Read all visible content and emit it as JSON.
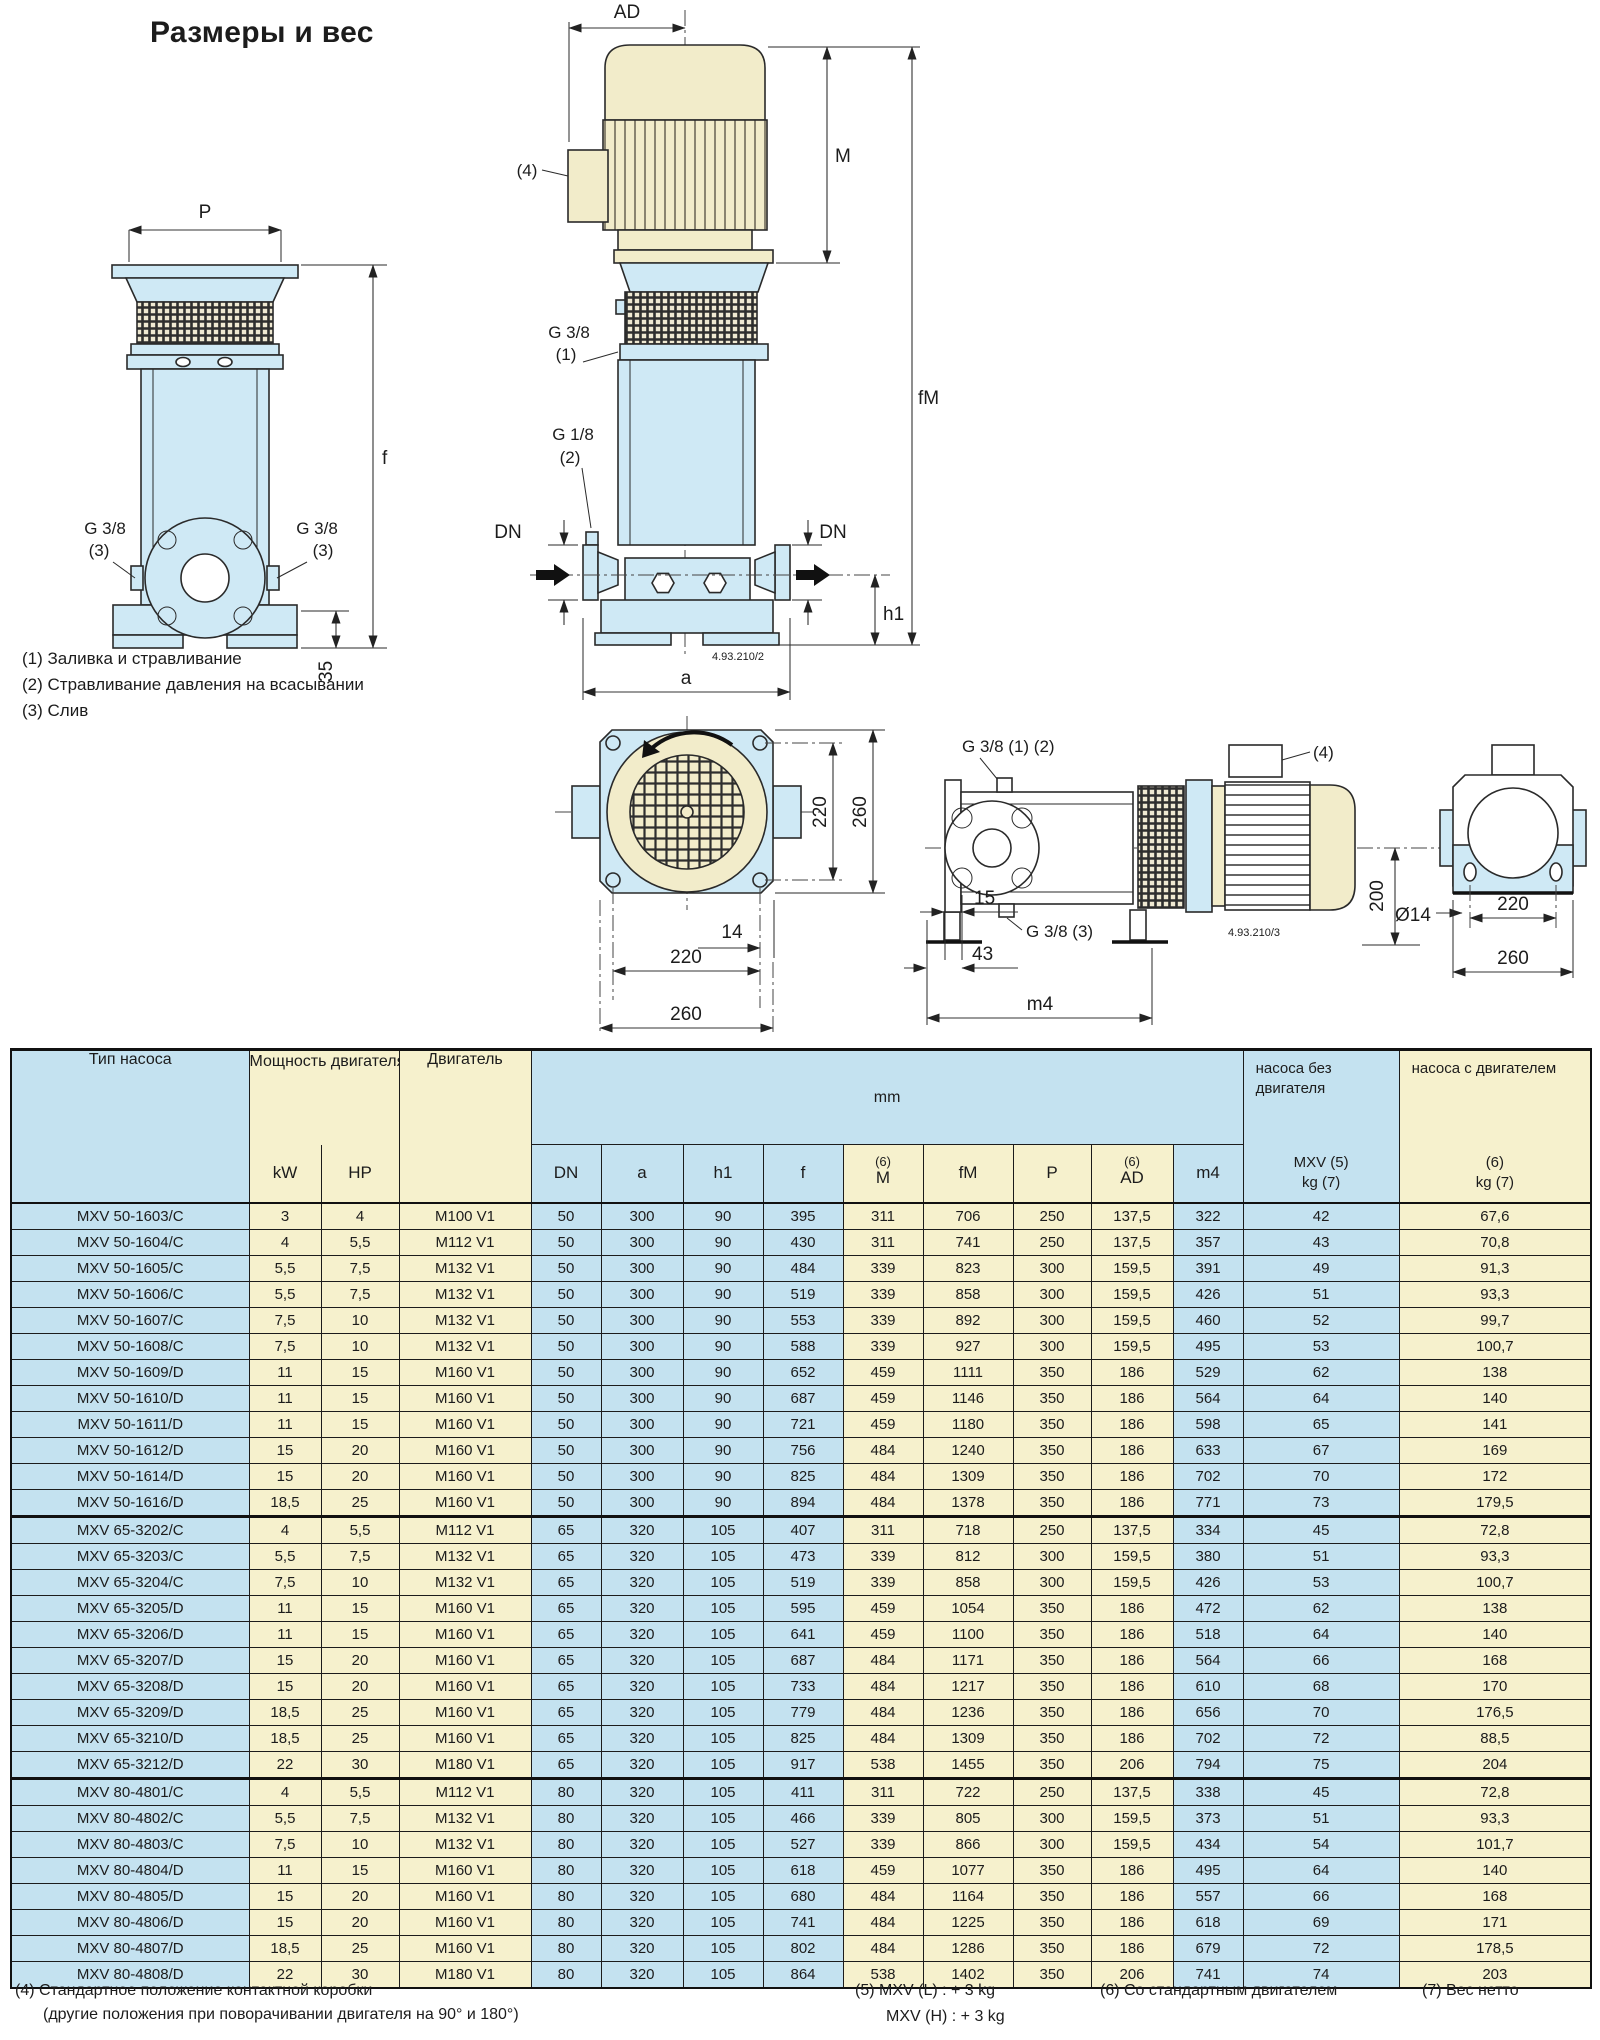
{
  "page": {
    "title": "Размеры и вес",
    "notes_left": {
      "n1": "(1) Заливка и стравливание",
      "n2": "(2) Стравливание давления на всасывании",
      "n3": "(3) Слив"
    },
    "footer_notes": {
      "n4_line1": "(4) Стандартное положение контактной коробки",
      "n4_line2": "(другие положения при поворачивании двигателя на 90° и 180°)",
      "n5_line1": "(5) MXV (L) : + 3 kg",
      "n5_line2": "MXV (H) : + 3 kg",
      "n6": "(6) Со стандартным двигателем",
      "n7": "(7) Вес нетто"
    },
    "colors": {
      "table_blue": "#c4e2f0",
      "table_yellow": "#f6f1cd",
      "drawing_blue": "#cfe9f5",
      "drawing_cream": "#f2ecca"
    }
  },
  "drawings": {
    "left": {
      "p": "P",
      "f": "f",
      "g38": "G 3/8",
      "n3": "(3)",
      "d35": "35"
    },
    "middle": {
      "ad": "AD",
      "n4": "(4)",
      "m": "M",
      "fm": "fM",
      "g38": "G 3/8",
      "n1": "(1)",
      "g18": "G 1/8",
      "n2": "(2)",
      "dn": "DN",
      "h1": "h1",
      "a": "a",
      "code": "4.93.210/2"
    },
    "bottom": {
      "v220": "220",
      "v260": "260",
      "d14": "14",
      "h220": "220",
      "h260": "260"
    },
    "right": {
      "g38_12": "G 3/8 (1) (2)",
      "g38_3": "G 3/8 (3)",
      "n4": "(4)",
      "code": "4.93.210/3",
      "d200": "200",
      "d14": "Ø14",
      "d15": "15",
      "d43": "43",
      "m4": "m4",
      "d220": "220",
      "d260": "260"
    }
  },
  "table": {
    "headers": {
      "type": "Тип насоса",
      "power": "Мощность двигателя",
      "kw": "kW",
      "hp": "HP",
      "motor": "Двигатель",
      "mm": "mm",
      "dn": "DN",
      "a": "a",
      "h1": "h1",
      "f": "f",
      "m6": "(6)",
      "m": "M",
      "fm": "fM",
      "p": "P",
      "ad6": "(6)",
      "ad": "AD",
      "m4": "m4",
      "w1_top": "насоса без двигателя",
      "w1_mid": "MXV (5)",
      "w1_bot": "kg (7)",
      "w2_top": "насоса с двигателем",
      "w2_mid": "(6)",
      "w2_bot": "kg (7)"
    },
    "columns": [
      "type",
      "kw",
      "hp",
      "motor",
      "dn",
      "a",
      "h1",
      "f",
      "m",
      "fm",
      "p",
      "ad",
      "m4",
      "kg1",
      "kg2"
    ],
    "col_colors": {
      "type": "b",
      "kw": "y",
      "hp": "y",
      "motor": "y",
      "dn": "b",
      "a": "b",
      "h1": "b",
      "f": "b",
      "m": "y",
      "fm": "y",
      "p": "y",
      "ad": "y",
      "m4": "b",
      "kg1": "b",
      "kg2": "y"
    },
    "groups": [
      [
        [
          "MXV 50-1603/C",
          "3",
          "4",
          "M100 V1",
          "50",
          "300",
          "90",
          "395",
          "311",
          "706",
          "250",
          "137,5",
          "322",
          "42",
          "67,6"
        ],
        [
          "MXV 50-1604/C",
          "4",
          "5,5",
          "M112 V1",
          "50",
          "300",
          "90",
          "430",
          "311",
          "741",
          "250",
          "137,5",
          "357",
          "43",
          "70,8"
        ],
        [
          "MXV 50-1605/C",
          "5,5",
          "7,5",
          "M132 V1",
          "50",
          "300",
          "90",
          "484",
          "339",
          "823",
          "300",
          "159,5",
          "391",
          "49",
          "91,3"
        ],
        [
          "MXV 50-1606/C",
          "5,5",
          "7,5",
          "M132 V1",
          "50",
          "300",
          "90",
          "519",
          "339",
          "858",
          "300",
          "159,5",
          "426",
          "51",
          "93,3"
        ],
        [
          "MXV 50-1607/C",
          "7,5",
          "10",
          "M132 V1",
          "50",
          "300",
          "90",
          "553",
          "339",
          "892",
          "300",
          "159,5",
          "460",
          "52",
          "99,7"
        ],
        [
          "MXV 50-1608/C",
          "7,5",
          "10",
          "M132 V1",
          "50",
          "300",
          "90",
          "588",
          "339",
          "927",
          "300",
          "159,5",
          "495",
          "53",
          "100,7"
        ],
        [
          "MXV 50-1609/D",
          "11",
          "15",
          "M160 V1",
          "50",
          "300",
          "90",
          "652",
          "459",
          "1111",
          "350",
          "186",
          "529",
          "62",
          "138"
        ],
        [
          "MXV 50-1610/D",
          "11",
          "15",
          "M160 V1",
          "50",
          "300",
          "90",
          "687",
          "459",
          "1146",
          "350",
          "186",
          "564",
          "64",
          "140"
        ],
        [
          "MXV 50-1611/D",
          "11",
          "15",
          "M160 V1",
          "50",
          "300",
          "90",
          "721",
          "459",
          "1180",
          "350",
          "186",
          "598",
          "65",
          "141"
        ],
        [
          "MXV 50-1612/D",
          "15",
          "20",
          "M160 V1",
          "50",
          "300",
          "90",
          "756",
          "484",
          "1240",
          "350",
          "186",
          "633",
          "67",
          "169"
        ],
        [
          "MXV 50-1614/D",
          "15",
          "20",
          "M160 V1",
          "50",
          "300",
          "90",
          "825",
          "484",
          "1309",
          "350",
          "186",
          "702",
          "70",
          "172"
        ],
        [
          "MXV 50-1616/D",
          "18,5",
          "25",
          "M160 V1",
          "50",
          "300",
          "90",
          "894",
          "484",
          "1378",
          "350",
          "186",
          "771",
          "73",
          "179,5"
        ]
      ],
      [
        [
          "MXV 65-3202/C",
          "4",
          "5,5",
          "M112 V1",
          "65",
          "320",
          "105",
          "407",
          "311",
          "718",
          "250",
          "137,5",
          "334",
          "45",
          "72,8"
        ],
        [
          "MXV 65-3203/C",
          "5,5",
          "7,5",
          "M132 V1",
          "65",
          "320",
          "105",
          "473",
          "339",
          "812",
          "300",
          "159,5",
          "380",
          "51",
          "93,3"
        ],
        [
          "MXV 65-3204/C",
          "7,5",
          "10",
          "M132 V1",
          "65",
          "320",
          "105",
          "519",
          "339",
          "858",
          "300",
          "159,5",
          "426",
          "53",
          "100,7"
        ],
        [
          "MXV 65-3205/D",
          "11",
          "15",
          "M160 V1",
          "65",
          "320",
          "105",
          "595",
          "459",
          "1054",
          "350",
          "186",
          "472",
          "62",
          "138"
        ],
        [
          "MXV 65-3206/D",
          "11",
          "15",
          "M160 V1",
          "65",
          "320",
          "105",
          "641",
          "459",
          "1100",
          "350",
          "186",
          "518",
          "64",
          "140"
        ],
        [
          "MXV 65-3207/D",
          "15",
          "20",
          "M160 V1",
          "65",
          "320",
          "105",
          "687",
          "484",
          "1171",
          "350",
          "186",
          "564",
          "66",
          "168"
        ],
        [
          "MXV 65-3208/D",
          "15",
          "20",
          "M160 V1",
          "65",
          "320",
          "105",
          "733",
          "484",
          "1217",
          "350",
          "186",
          "610",
          "68",
          "170"
        ],
        [
          "MXV 65-3209/D",
          "18,5",
          "25",
          "M160 V1",
          "65",
          "320",
          "105",
          "779",
          "484",
          "1236",
          "350",
          "186",
          "656",
          "70",
          "176,5"
        ],
        [
          "MXV 65-3210/D",
          "18,5",
          "25",
          "M160 V1",
          "65",
          "320",
          "105",
          "825",
          "484",
          "1309",
          "350",
          "186",
          "702",
          "72",
          "88,5"
        ],
        [
          "MXV 65-3212/D",
          "22",
          "30",
          "M180 V1",
          "65",
          "320",
          "105",
          "917",
          "538",
          "1455",
          "350",
          "206",
          "794",
          "75",
          "204"
        ]
      ],
      [
        [
          "MXV 80-4801/C",
          "4",
          "5,5",
          "M112 V1",
          "80",
          "320",
          "105",
          "411",
          "311",
          "722",
          "250",
          "137,5",
          "338",
          "45",
          "72,8"
        ],
        [
          "MXV 80-4802/C",
          "5,5",
          "7,5",
          "M132 V1",
          "80",
          "320",
          "105",
          "466",
          "339",
          "805",
          "300",
          "159,5",
          "373",
          "51",
          "93,3"
        ],
        [
          "MXV 80-4803/C",
          "7,5",
          "10",
          "M132 V1",
          "80",
          "320",
          "105",
          "527",
          "339",
          "866",
          "300",
          "159,5",
          "434",
          "54",
          "101,7"
        ],
        [
          "MXV 80-4804/D",
          "11",
          "15",
          "M160 V1",
          "80",
          "320",
          "105",
          "618",
          "459",
          "1077",
          "350",
          "186",
          "495",
          "64",
          "140"
        ],
        [
          "MXV 80-4805/D",
          "15",
          "20",
          "M160 V1",
          "80",
          "320",
          "105",
          "680",
          "484",
          "1164",
          "350",
          "186",
          "557",
          "66",
          "168"
        ],
        [
          "MXV 80-4806/D",
          "15",
          "20",
          "M160 V1",
          "80",
          "320",
          "105",
          "741",
          "484",
          "1225",
          "350",
          "186",
          "618",
          "69",
          "171"
        ],
        [
          "MXV 80-4807/D",
          "18,5",
          "25",
          "M160 V1",
          "80",
          "320",
          "105",
          "802",
          "484",
          "1286",
          "350",
          "186",
          "679",
          "72",
          "178,5"
        ],
        [
          "MXV 80-4808/D",
          "22",
          "30",
          "M180 V1",
          "80",
          "320",
          "105",
          "864",
          "538",
          "1402",
          "350",
          "206",
          "741",
          "74",
          "203"
        ]
      ]
    ]
  }
}
